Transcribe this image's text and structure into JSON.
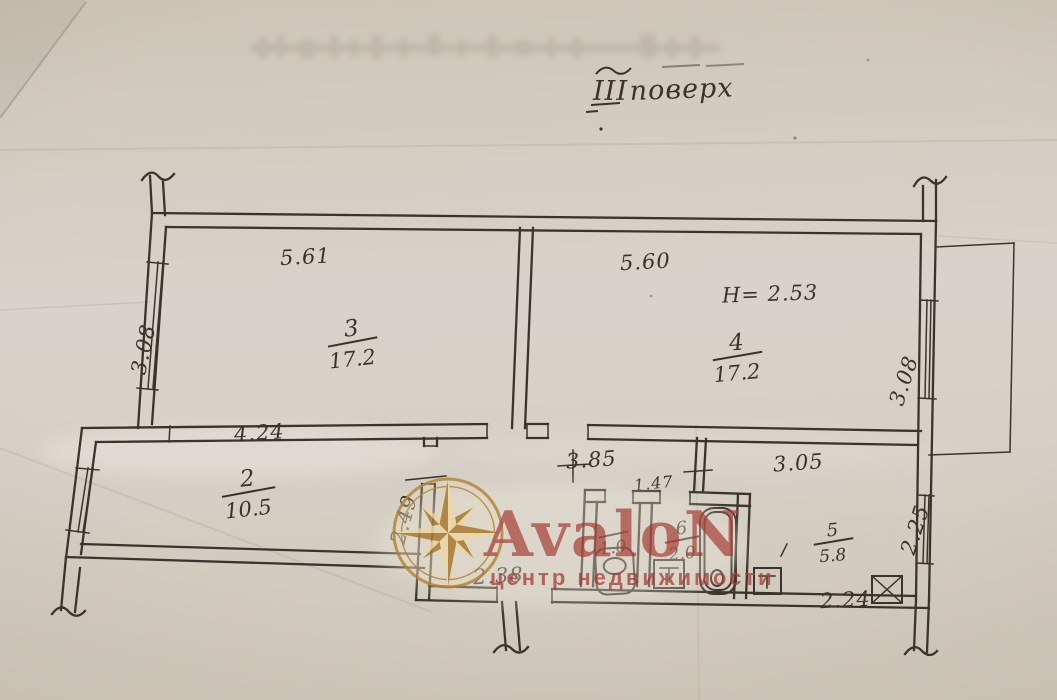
{
  "title": {
    "roman": "III",
    "word": "поверх"
  },
  "annotations": {
    "ceiling_height": "H= 2.53"
  },
  "rooms": {
    "r2": {
      "number": "2",
      "area": "10.5"
    },
    "r3": {
      "number": "3",
      "area": "17.2"
    },
    "r4": {
      "number": "4",
      "area": "17.2"
    },
    "r5": {
      "number": "5",
      "area": "5.8"
    },
    "r6": {
      "number": "6",
      "area": "2.0"
    },
    "wc": {
      "number": "",
      "area": "1.0"
    }
  },
  "dims": {
    "room3_width": "5.61",
    "room4_width": "5.60",
    "room3_depth": "3.08",
    "room4_depth": "3.08",
    "room2_width": "4.24",
    "room2_depth": "2.49",
    "hall_width": "3.85",
    "room5_width": "3.05",
    "bath_width": "1.47",
    "hall_bottom": "2.38",
    "room5_bottom": "2.24",
    "room5_depth": "2.25"
  },
  "watermark": {
    "brand": "AvaloN",
    "tagline": "центр недвижимости"
  },
  "colors": {
    "ink": "#3a342c",
    "handwriting": "#3b332a",
    "watermark_red": "#a8423a",
    "star_dark": "#ab7d33",
    "star_light": "#ead9a8",
    "star_ring": "#b6893f",
    "paper": "#d0cabd"
  }
}
